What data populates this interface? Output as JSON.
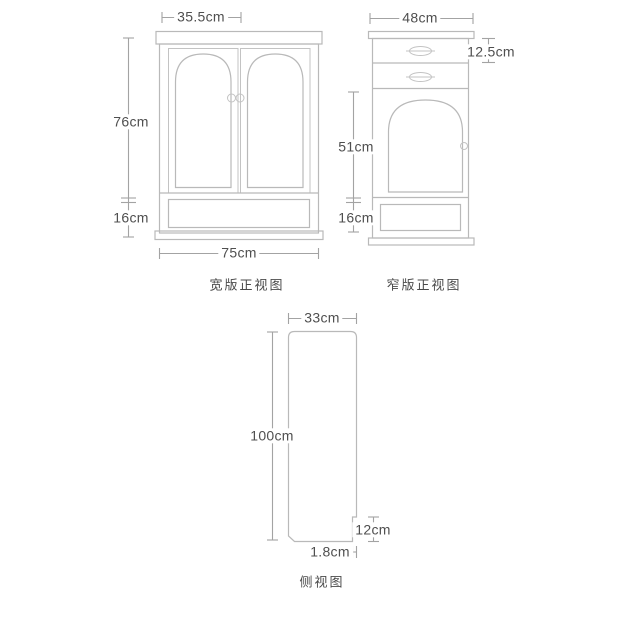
{
  "views": {
    "wide_front": {
      "title": "宽版正视图",
      "dimensions": {
        "door_width": "35.5cm",
        "upper_height": "76cm",
        "base_height": "16cm",
        "total_width": "75cm"
      }
    },
    "narrow_front": {
      "title": "窄版正视图",
      "dimensions": {
        "total_width": "48cm",
        "drawer_height": "12.5cm",
        "door_height": "51cm",
        "base_height": "16cm"
      }
    },
    "side": {
      "title": "侧视图",
      "dimensions": {
        "depth": "33cm",
        "height": "100cm",
        "toe_kick_height": "12cm",
        "toe_kick_depth": "1.8cm"
      }
    }
  },
  "colors": {
    "background": "#ffffff",
    "furniture_line": "#b9b9b9",
    "dimension_line": "#a3a3a3",
    "text": "#4f4f4f"
  }
}
